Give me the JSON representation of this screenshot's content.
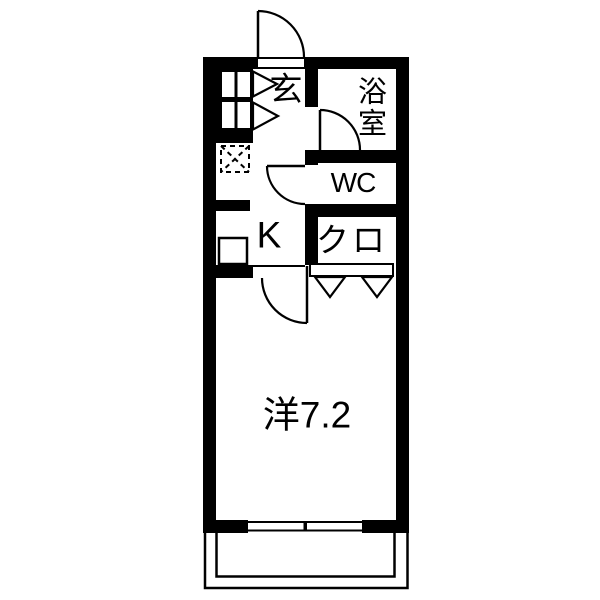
{
  "title": "apartment floor plan",
  "colors": {
    "background": "#ffffff",
    "walls": "#000000",
    "lines": "#000000"
  },
  "rooms": {
    "entrance": {
      "label": "玄"
    },
    "bathroom": {
      "label": "浴室"
    },
    "toilet": {
      "label": "WC"
    },
    "closet": {
      "label": "クロ"
    },
    "kitchen": {
      "label": "K"
    },
    "main_room": {
      "label": "洋7.2"
    }
  },
  "symbols": {
    "entrance_door": "swing-door",
    "bathroom_door": "swing-door",
    "toilet_door": "swing-door",
    "main_room_door": "swing-door",
    "closet_door": "double-leaf-door-v-marks",
    "shoe_cabinet": "shoe-cabinet",
    "refrigerator_space": "dashed-box-with-x",
    "kitchen_sink": "square-fixture",
    "window": "sliding-window",
    "balcony": "balcony-outline"
  }
}
